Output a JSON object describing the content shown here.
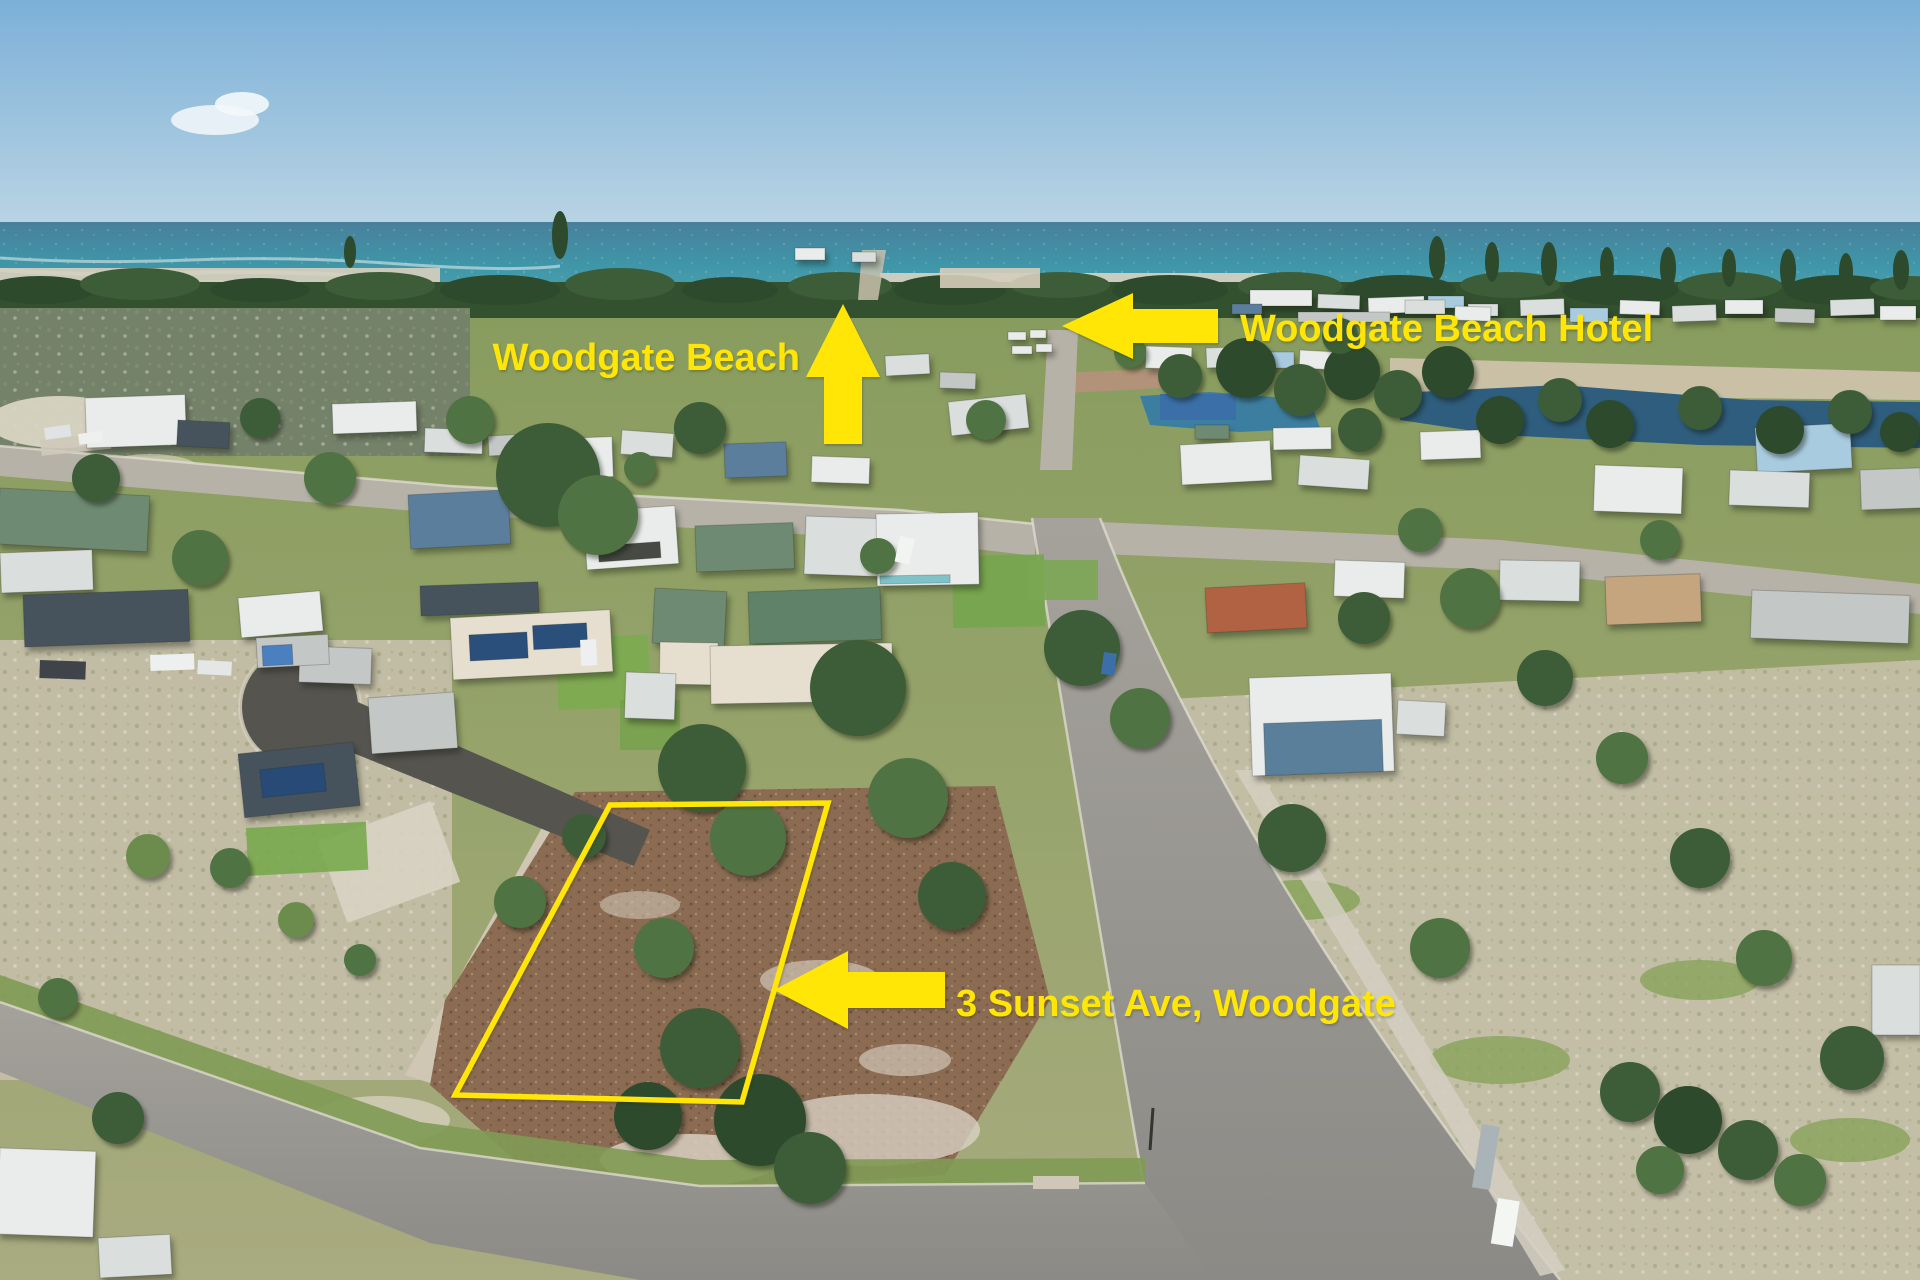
{
  "annotations": {
    "beach": {
      "label": "Woodgate Beach",
      "arrow_direction": "up"
    },
    "hotel": {
      "label": "Woodgate Beach Hotel",
      "arrow_direction": "left"
    },
    "property": {
      "label": "3 Sunset Ave, Woodgate",
      "arrow_direction": "left",
      "boundary": "yellow outlined vacant lot"
    }
  },
  "colors": {
    "annotation_yellow": "#FFE606",
    "sky": "#7CB0D8",
    "sea": "#4095A8",
    "lot_dirt": "#8B6C53",
    "road": "#999690"
  }
}
